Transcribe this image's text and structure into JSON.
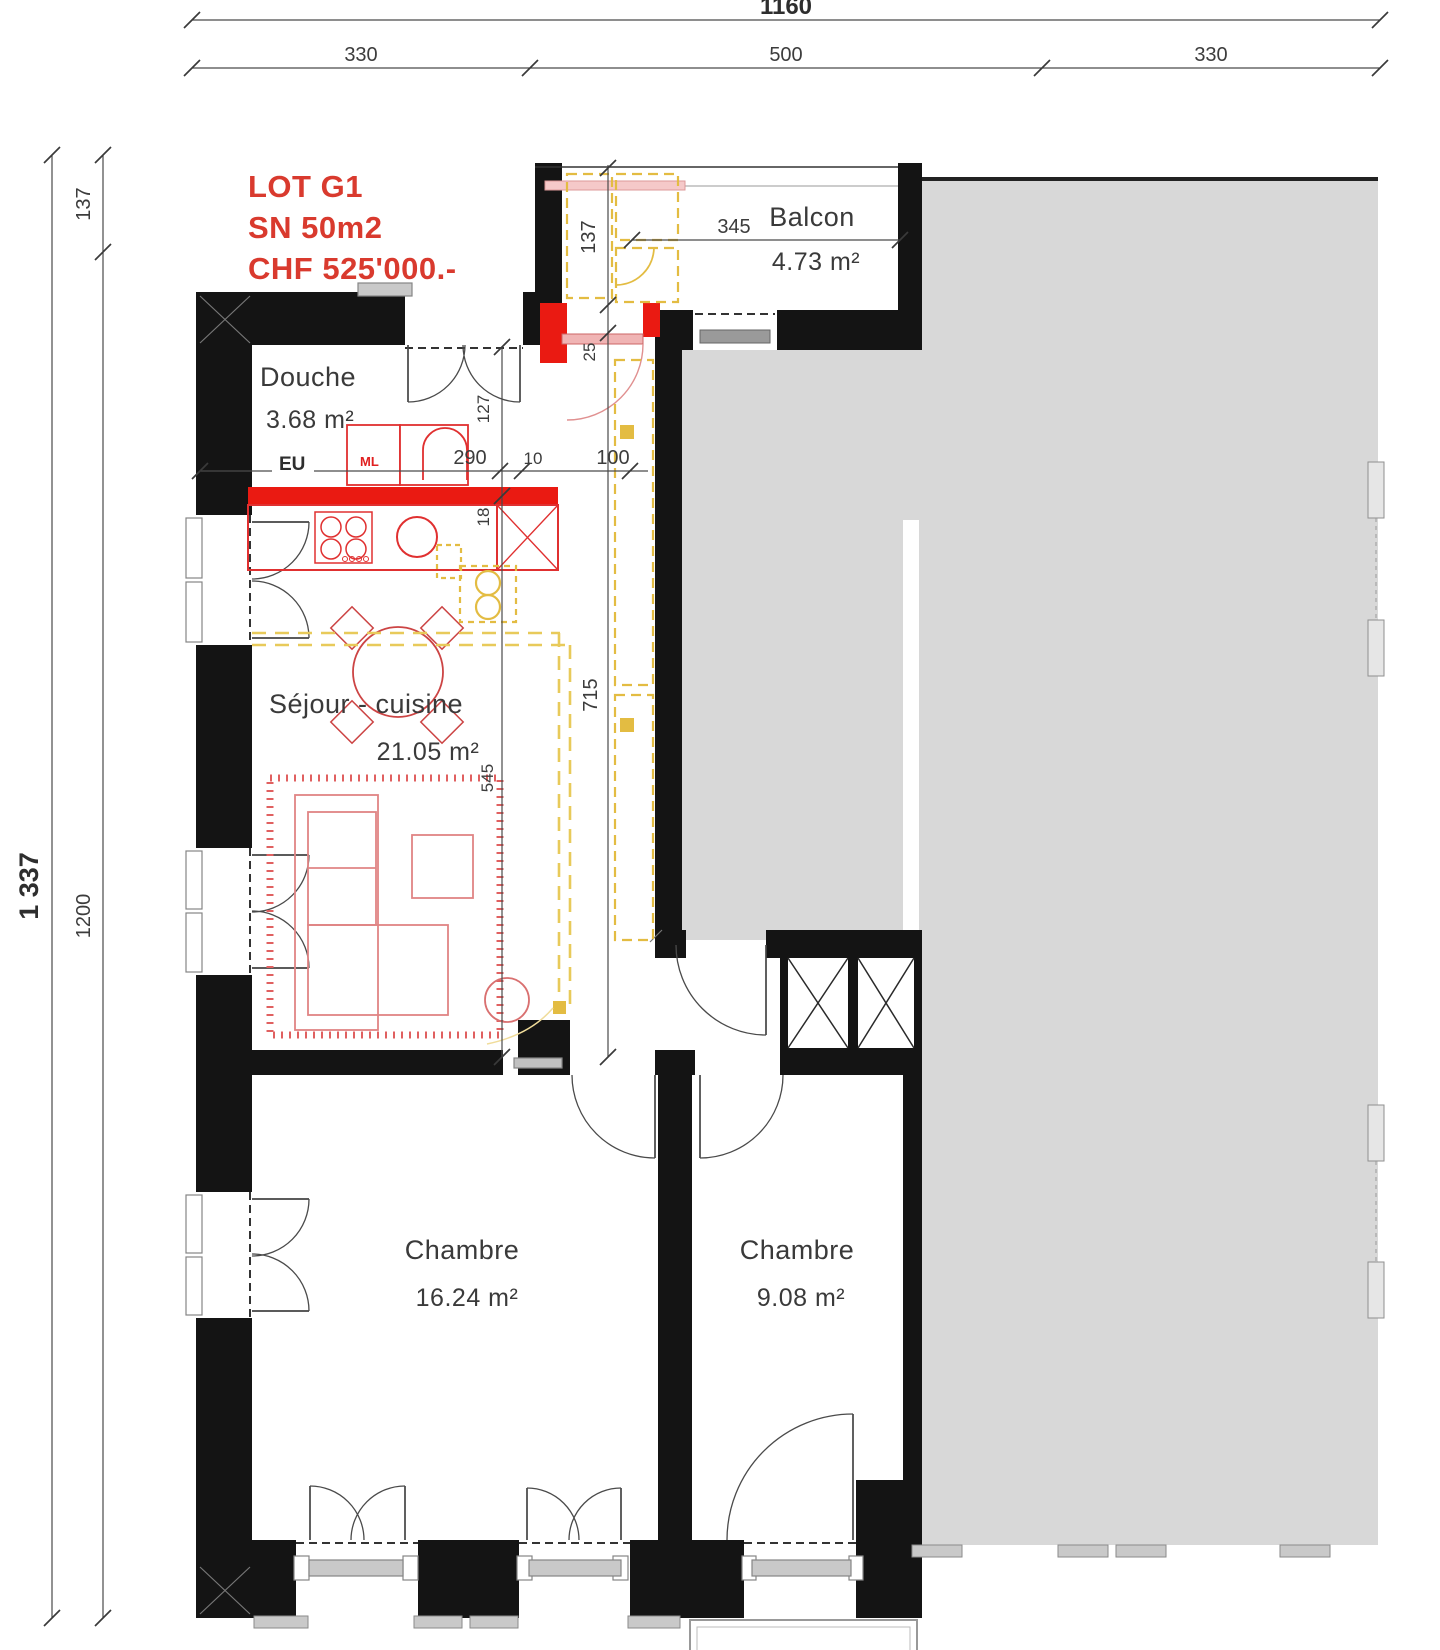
{
  "lot": {
    "name": "LOT G1",
    "surface": "SN 50m2",
    "price": "CHF 525'000.-"
  },
  "rooms": {
    "balcony": {
      "name": "Balcon",
      "area": "4.73 m²"
    },
    "shower": {
      "name": "Douche",
      "area": "3.68 m²"
    },
    "living": {
      "name": "Séjour - cuisine",
      "area": "21.05 m²"
    },
    "bedroom1": {
      "name": "Chambre",
      "area": "16.24 m²"
    },
    "bedroom2": {
      "name": "Chambre",
      "area": "9.08 m²"
    }
  },
  "dimensions": {
    "total_width": "1160",
    "width_segments": [
      "330",
      "500",
      "330"
    ],
    "total_height": "1 337",
    "height_upper": "137",
    "height_lower": "1200",
    "entry_depth": "137",
    "wall_25": "25",
    "hall_length": "715",
    "balcony_width": "345",
    "kitchen_width": "290",
    "wall_10": "10",
    "hall_width": "100",
    "niche_depth": "127",
    "offset_18": "18",
    "living_length": "545"
  },
  "annotations": {
    "waste_water": "EU",
    "washing_machine": "ML"
  },
  "colors": {
    "wall_black": "#141414",
    "new_wall_red": "#ea1a12",
    "lot_text_red": "#d93a2e",
    "furniture_red": "#cc4444",
    "sofa_pink": "#e08484",
    "wardrobe_yellow": "#e3bc42",
    "neighbor_gray": "#d8d8d8",
    "dimension_line": "#4a4a4a",
    "label_text": "#3a3a3a"
  }
}
